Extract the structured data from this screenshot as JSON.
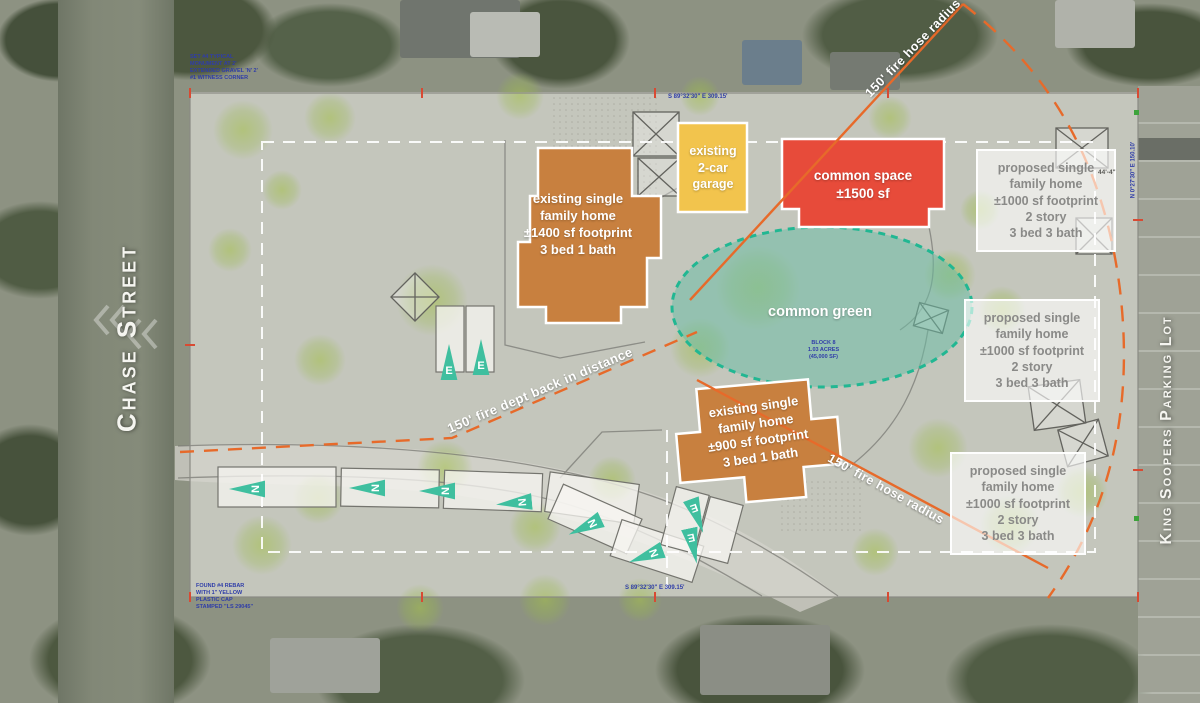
{
  "streets": {
    "left_label": "Chase Street",
    "right_label": "King Soopers Parking Lot"
  },
  "buildings": {
    "existing_home_1": {
      "lines": [
        "existing single",
        "family home",
        "±1400 sf footprint",
        "3 bed 1 bath"
      ]
    },
    "garage": {
      "lines": [
        "existing",
        "2-car",
        "garage"
      ]
    },
    "common_space": {
      "lines": [
        "common space",
        "±1500 sf"
      ]
    },
    "existing_home_2": {
      "lines": [
        "existing single",
        "family home",
        "±900 sf footprint",
        "3 bed 1 bath"
      ]
    },
    "proposed_1": {
      "lines": [
        "proposed single",
        "family home",
        "±1000 sf footprint",
        "2 story",
        "3 bed 3 bath"
      ]
    },
    "proposed_2": {
      "lines": [
        "proposed single",
        "family home",
        "±1000 sf footprint",
        "2 story",
        "3 bed 3 bath"
      ]
    },
    "proposed_3": {
      "lines": [
        "proposed single",
        "family home",
        "±1000 sf footprint",
        "2 story",
        "3 bed 3 bath"
      ]
    }
  },
  "common_green": {
    "label": "common green",
    "note_lines": [
      "BLOCK 8",
      "1.03 ACRES",
      "(45,000 SF)"
    ]
  },
  "fire_annotations": {
    "hose_radius_top": "150' fire hose radius",
    "hose_radius_bottom": "150' fire hose radius",
    "dept_back_in": "150' fire dept back in distance"
  },
  "survey": {
    "top_left_lines": [
      "SET #4 TYPICAL",
      "MONUMENT AT 2'",
      "EXTENDED GRAVEL 'N' 2'",
      "#1 WITNESS CORNER"
    ],
    "bottom_left_lines": [
      "FOUND #4 REBAR",
      "WITH 1\" YELLOW",
      "PLASTIC CAP",
      "STAMPED \"LS 29045\""
    ],
    "top_dimension": "S 89°32'30\" E  309.15'",
    "bottom_dimension": "S 89°32'30\" E  309.15'",
    "right_dimension": "N 0°27'30\" E  150.10'",
    "shed_dimension": "44'-4\""
  },
  "parking_markers": [
    {
      "letter": "N",
      "x": 247,
      "y": 489,
      "rot": -90
    },
    {
      "letter": "N",
      "x": 367,
      "y": 488,
      "rot": -90
    },
    {
      "letter": "N",
      "x": 437,
      "y": 491,
      "rot": -90
    },
    {
      "letter": "N",
      "x": 514,
      "y": 503,
      "rot": -95
    },
    {
      "letter": "N",
      "x": 585,
      "y": 527,
      "rot": -115
    },
    {
      "letter": "N",
      "x": 646,
      "y": 556,
      "rot": -110
    },
    {
      "letter": "E",
      "x": 449,
      "y": 362,
      "rot": 0
    },
    {
      "letter": "E",
      "x": 481,
      "y": 357,
      "rot": 0
    },
    {
      "letter": "E",
      "x": 697,
      "y": 516,
      "rot": 160
    },
    {
      "letter": "E",
      "x": 693,
      "y": 546,
      "rot": 168
    }
  ],
  "colors": {
    "existing_fill": "#c8803f",
    "garage_fill": "#f2c44d",
    "common_space_fill": "#e74b3a",
    "common_green_fill": "rgba(110,190,165,0.55)",
    "common_green_stroke": "#21b792",
    "fire_line": "#e76a2a",
    "marker_teal": "#3fbf9f",
    "proposed_text": "#8a8a88"
  }
}
